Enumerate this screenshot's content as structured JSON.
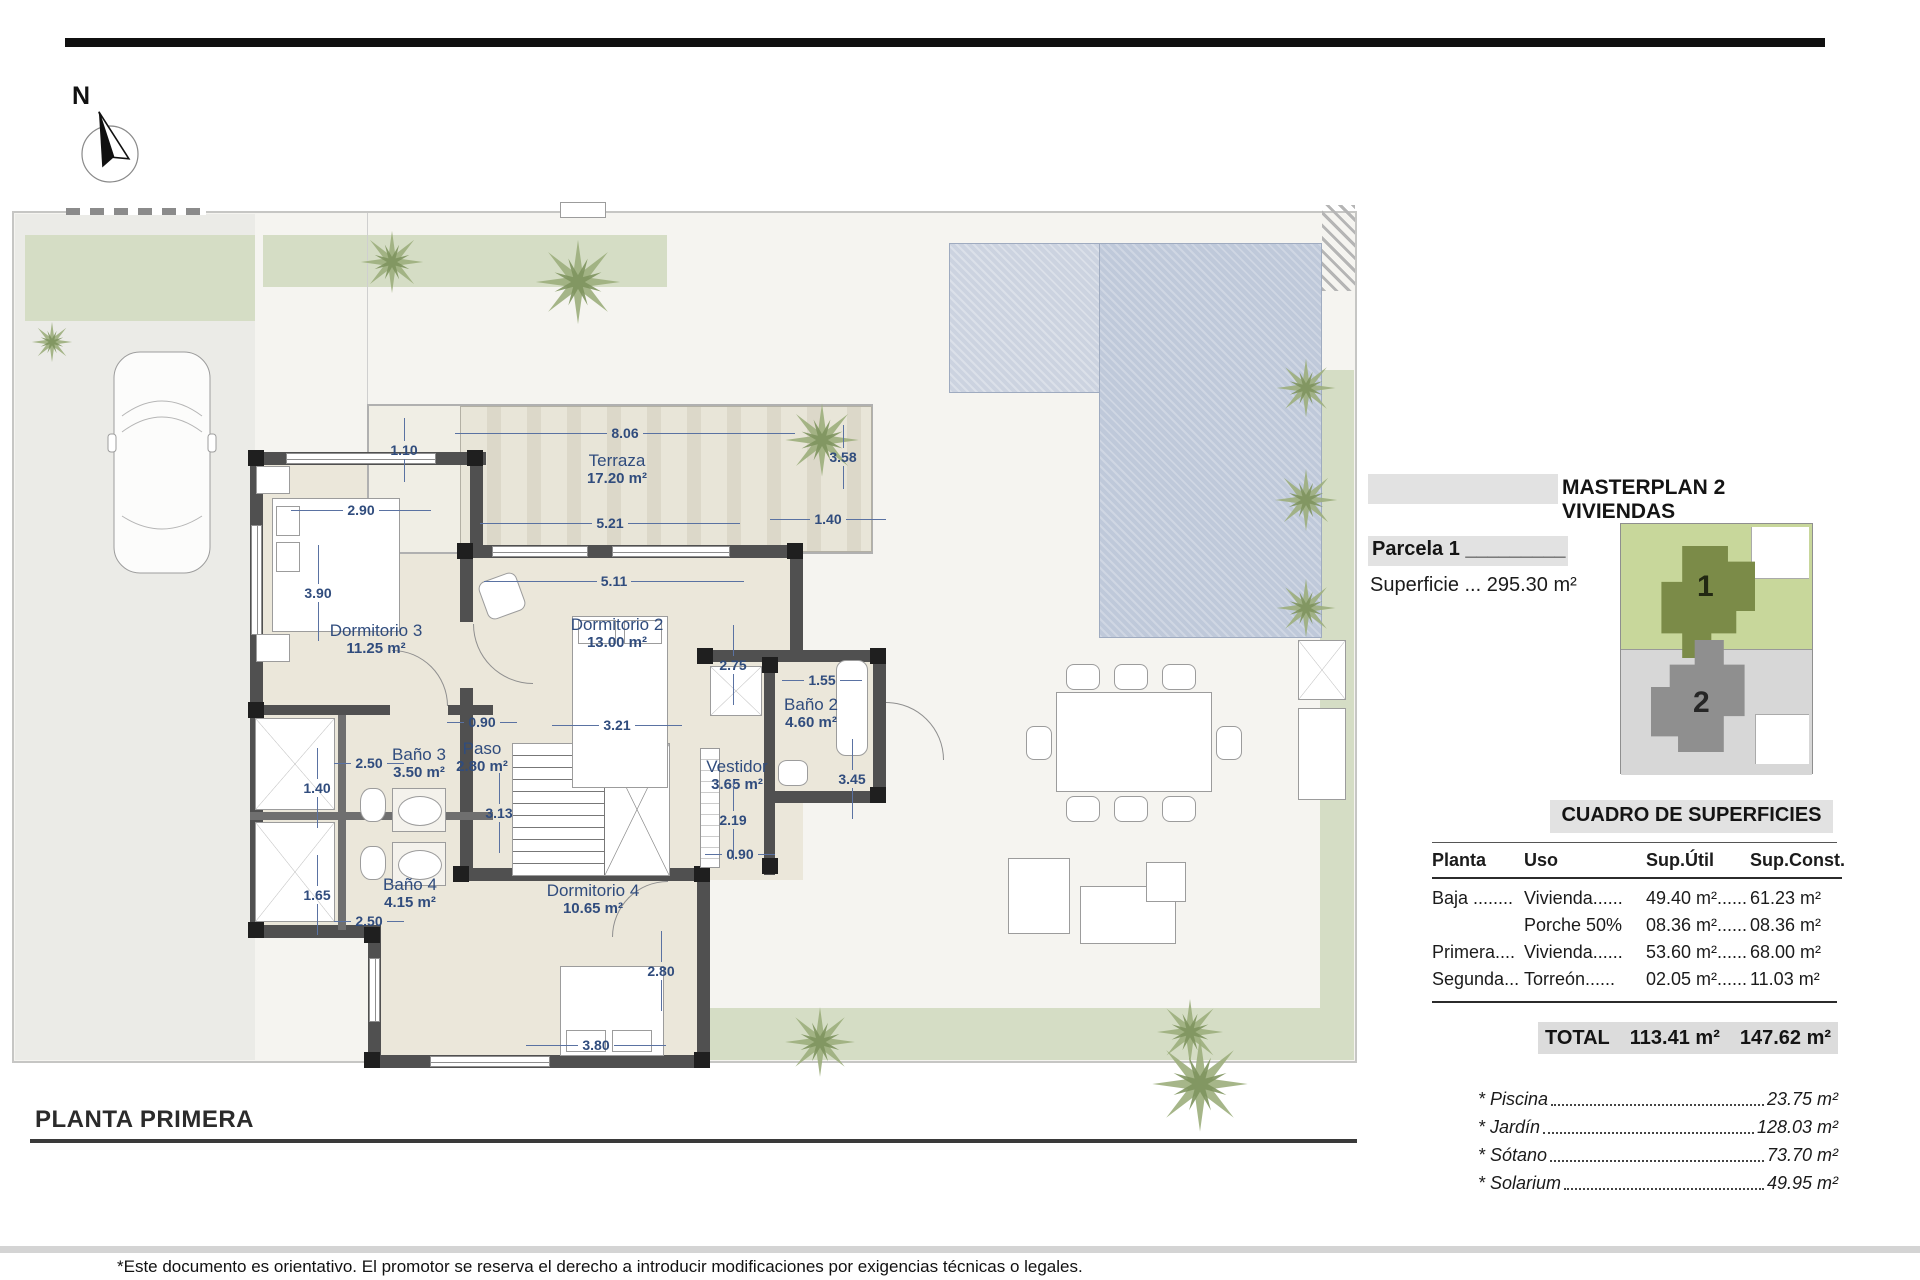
{
  "north_label": "N",
  "plan_title": {
    "label": "PLANTA PRIMERA"
  },
  "footer": {
    "disclaimer": "*Este documento es orientativo. El promotor se reserva el derecho a introducir modificaciones por exigencias técnicas o legales."
  },
  "masterplan": {
    "title": "MASTERPLAN 2 VIVIENDAS",
    "parcel_label": "Parcela 1 _________",
    "superficie": "Superficie ... 295.30 m²",
    "unit1": "1",
    "unit2": "2"
  },
  "surfaces": {
    "title": "CUADRO DE SUPERFICIES",
    "headers": [
      "Planta",
      "Uso",
      "Sup.Útil",
      "Sup.Const."
    ],
    "rows": [
      [
        "Baja ........",
        "Vivienda......",
        "49.40 m²......",
        "61.23 m²"
      ],
      [
        "",
        "Porche 50%",
        "08.36 m²......",
        "08.36 m²"
      ],
      [
        "Primera....",
        "Vivienda......",
        "53.60 m²......",
        "68.00 m²"
      ],
      [
        "Segunda...",
        "Torreón......",
        "02.05 m²......",
        "11.03 m²"
      ]
    ],
    "total": {
      "label": "TOTAL",
      "util": "113.41 m²",
      "const": "147.62 m²"
    },
    "extras": [
      {
        "label": "* Piscina",
        "value": "23.75 m²"
      },
      {
        "label": "* Jardín",
        "value": "128.03 m²"
      },
      {
        "label": "* Sótano",
        "value": "73.70 m²"
      },
      {
        "label": "* Solarium",
        "value": "49.95 m²"
      }
    ]
  },
  "plan": {
    "rooms": [
      {
        "name": "Terraza",
        "area": "17.20 m²"
      },
      {
        "name": "Dormitorio 3",
        "area": "11.25 m²"
      },
      {
        "name": "Dormitorio 2",
        "area": "13.00 m²"
      },
      {
        "name": "Baño 2",
        "area": "4.60 m²"
      },
      {
        "name": "Vestidor",
        "area": "3.65 m²"
      },
      {
        "name": "Paso",
        "area": "2.80 m²"
      },
      {
        "name": "Baño 3",
        "area": "3.50 m²"
      },
      {
        "name": "Baño 4",
        "area": "4.15 m²"
      },
      {
        "name": "Dormitorio 4",
        "area": "10.65 m²"
      }
    ],
    "dims": [
      "8.06",
      "1.10",
      "3.58",
      "2.90",
      "5.21",
      "1.40",
      "5.11",
      "3.90",
      "2.75",
      "1.55",
      "0.90",
      "3.21",
      "3.45",
      "2.19",
      "0.90",
      "2.50",
      "1.40",
      "3.13",
      "1.65",
      "2.50",
      "2.80",
      "3.80"
    ]
  },
  "colors": {
    "dim_text": "#304c7d",
    "garden": "#d5ddc5",
    "pool": "#bfc9da",
    "parcel1_bg": "#c8d79b",
    "parcel1_house": "#7b8b48",
    "parcel2_bg": "#d7d7d7",
    "parcel2_house": "#8f8f8f"
  }
}
